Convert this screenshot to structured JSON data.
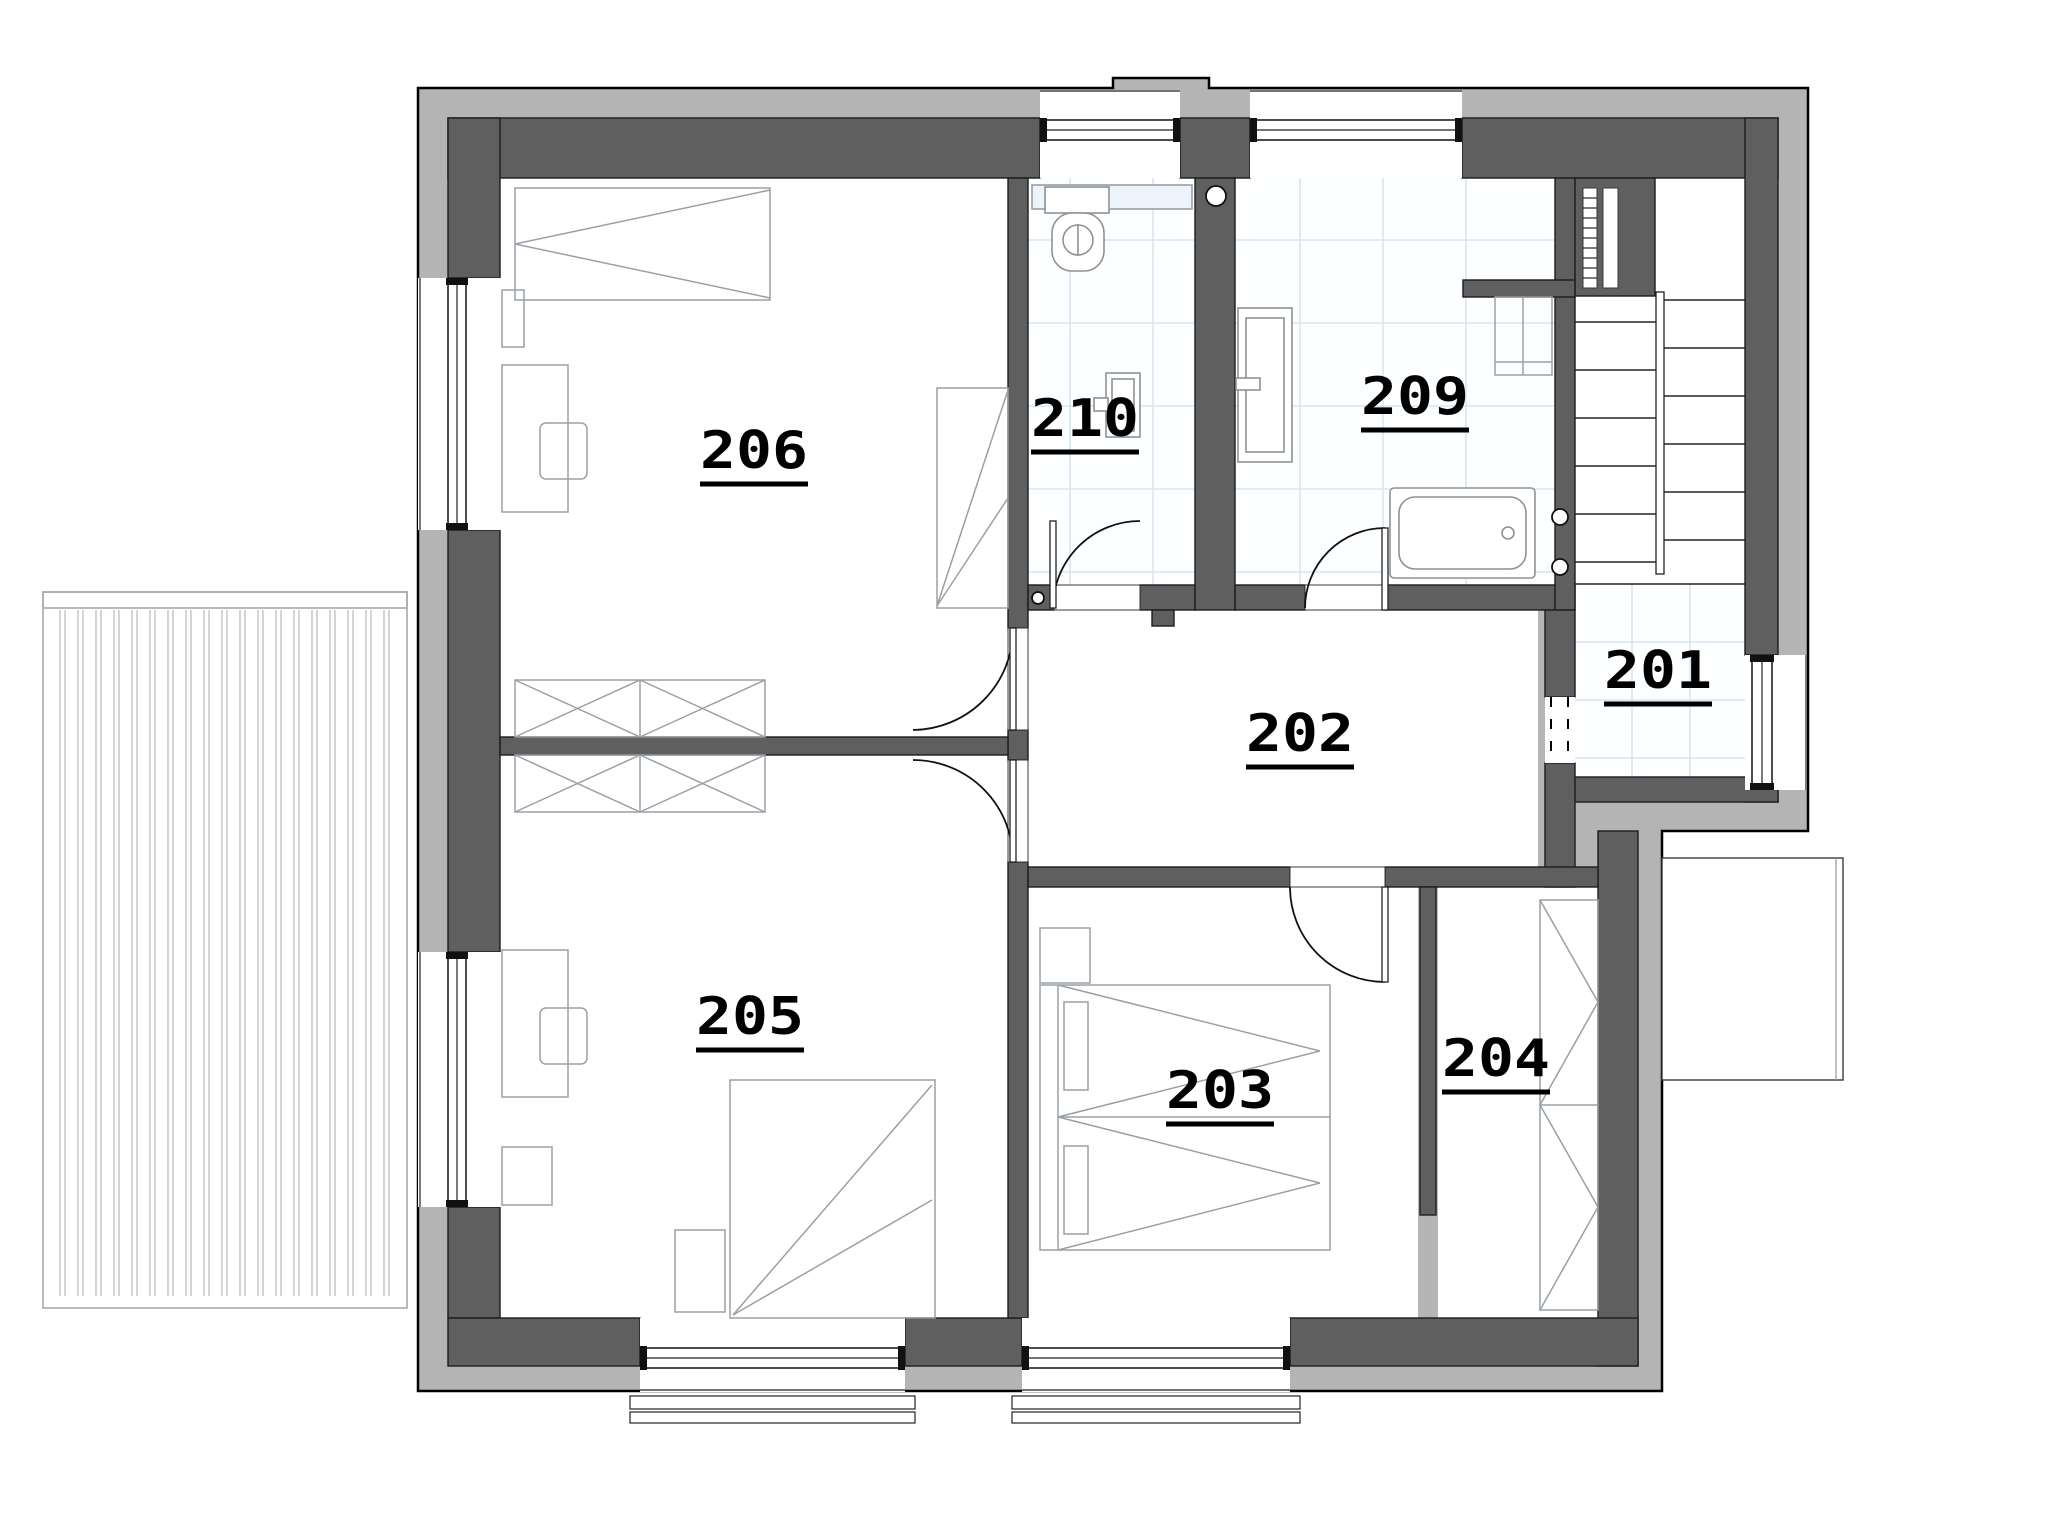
{
  "plan": {
    "type": "architectural-floor-plan",
    "floor": "second",
    "colors": {
      "structural_wall": "#5f5f5f",
      "insulation_layer": "#b4b4b4",
      "tile_grid_line": "#d8e4f2",
      "furniture_line": "#9aa0a5",
      "background": "#ffffff"
    },
    "rooms": [
      {
        "number": "201",
        "type": "stair-landing",
        "floor_finish": "tile",
        "fixtures": [
          "staircase",
          "window"
        ]
      },
      {
        "number": "202",
        "type": "hallway",
        "floor_finish": "none",
        "fixtures": []
      },
      {
        "number": "203",
        "type": "bedroom",
        "floor_finish": "none",
        "fixtures": [
          "double-bed",
          "nightstand"
        ]
      },
      {
        "number": "204",
        "type": "walk-in-closet",
        "floor_finish": "none",
        "fixtures": [
          "wardrobe"
        ]
      },
      {
        "number": "205",
        "type": "bedroom",
        "floor_finish": "none",
        "fixtures": [
          "bed",
          "desk",
          "chair",
          "wardrobe",
          "nightstand",
          "window"
        ]
      },
      {
        "number": "206",
        "type": "bedroom",
        "floor_finish": "none",
        "fixtures": [
          "bed",
          "desk",
          "chair",
          "wardrobe",
          "window"
        ]
      },
      {
        "number": "209",
        "type": "bathroom",
        "floor_finish": "tile",
        "fixtures": [
          "bathtub",
          "sink",
          "wall-cabinet",
          "radiator",
          "duct-shaft",
          "window"
        ]
      },
      {
        "number": "210",
        "type": "wc",
        "floor_finish": "tile",
        "fixtures": [
          "toilet",
          "hand-basin",
          "shelf",
          "window"
        ]
      }
    ],
    "outdoor": [
      {
        "name": "balcony-terrace",
        "finish": "wood-decking"
      },
      {
        "name": "lower-roof-outline"
      }
    ]
  }
}
